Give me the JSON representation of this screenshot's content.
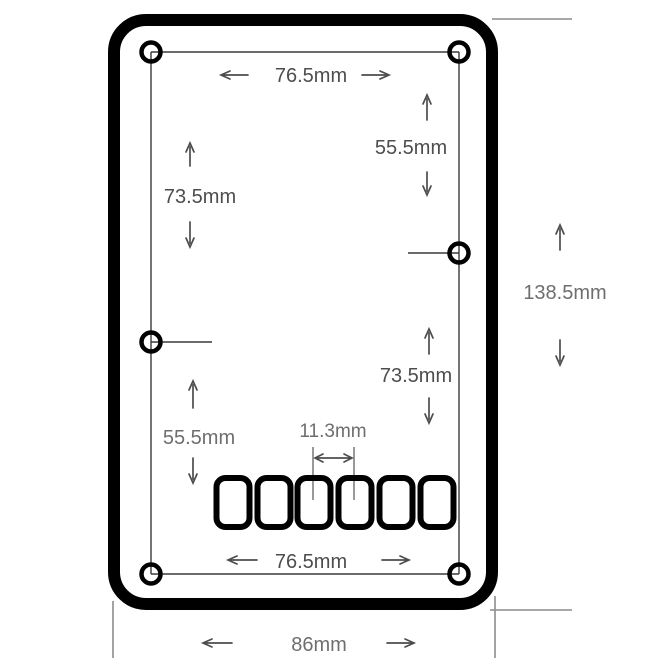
{
  "drawing": {
    "type": "mechanical-dimension-drawing",
    "part": "rounded rectangular faceplate with 6 screw holes and 6 bottom slots",
    "slot_count": 6,
    "hole_count": 6
  },
  "dimensions": {
    "top_hole_spacing": "76.5mm",
    "upper_right_vertical": "55.5mm",
    "upper_left_vertical": "73.5mm",
    "overall_height": "138.5mm",
    "lower_right_vertical": "73.5mm",
    "lower_left_vertical": "55.5mm",
    "slot_pitch": "11.3mm",
    "bottom_hole_spacing": "76.5mm",
    "overall_width": "86mm"
  },
  "colors": {
    "outline": "#000000",
    "dim_line": "#3a3a3a",
    "text_dark": "#4d4d4d",
    "text_gray": "#6e6e6e",
    "extension_line": "#8c8c8c"
  }
}
